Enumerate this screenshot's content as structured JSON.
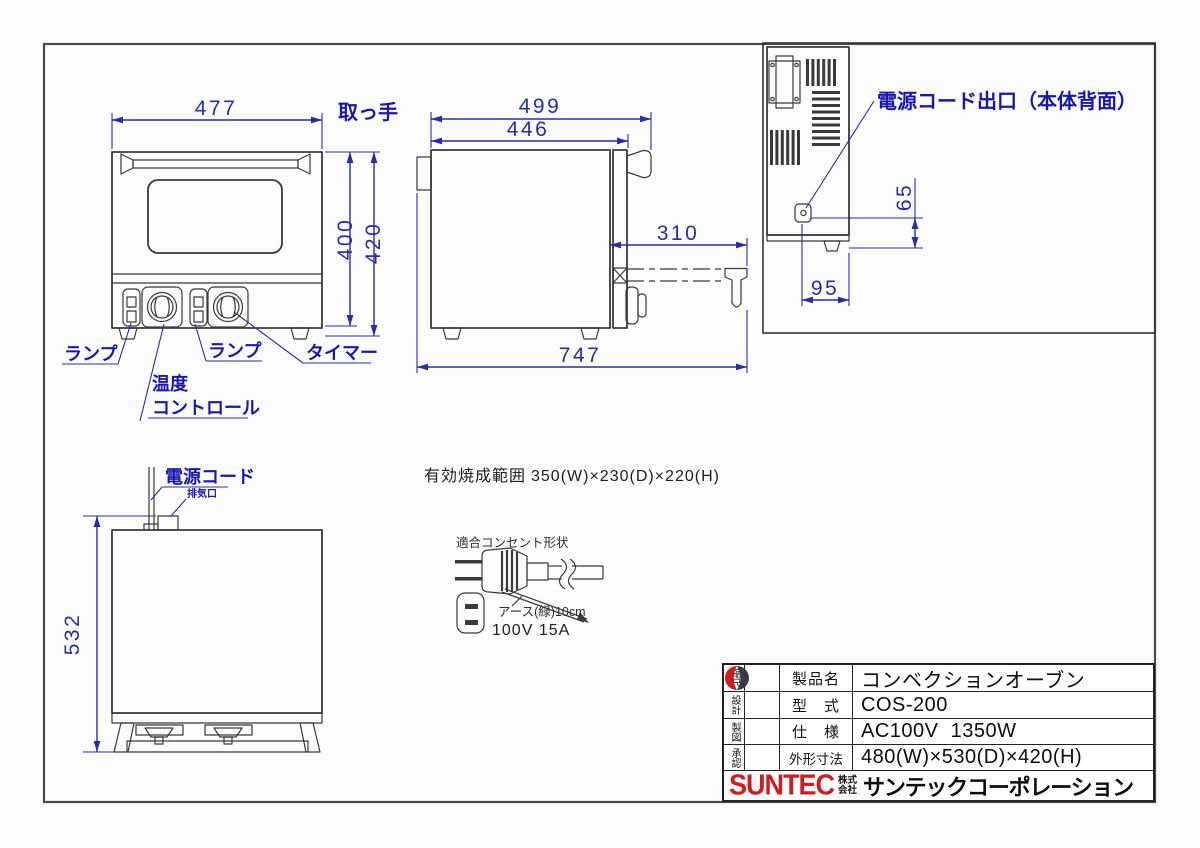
{
  "front_view": {
    "handle_label": "取っ手",
    "dim_width": "477",
    "dim_height_body": "400",
    "dim_height_total": "420",
    "label_lamp_left": "ランプ",
    "label_temp_line1": "温度",
    "label_temp_line2": "コントロール",
    "label_lamp_right": "ランプ",
    "label_timer": "タイマー"
  },
  "side_view": {
    "dim_width_total": "499",
    "dim_width_body": "446",
    "dim_door_open": "310",
    "dim_depth_total": "747"
  },
  "back_view": {
    "label_cord_outlet": "電源コード出口（本体背面）",
    "dim_outlet_height": "65",
    "dim_outlet_offset": "95"
  },
  "top_view": {
    "label_power_cord": "電源コード",
    "label_vent": "排気口",
    "dim_depth": "532"
  },
  "notes": {
    "baking_range_label": "有効焼成範囲",
    "baking_range_value": "350(W)×230(D)×220(H)",
    "plug_title": "適合コンセント形状",
    "ground_label": "アース(緑)10cm",
    "rating": "100V 15A"
  },
  "title_block": {
    "side_labels": [
      "縮尺",
      "設計",
      "製図",
      "承認"
    ],
    "rows": [
      {
        "label": "製品名",
        "value": "コンベクションオーブン"
      },
      {
        "label": "型　式",
        "value": "COS-200"
      },
      {
        "label": "仕　様",
        "value": "AC100V  1350W"
      },
      {
        "label": "外形寸法",
        "value": "480(W)×530(D)×420(H)"
      }
    ],
    "brand": "SUNTEC",
    "company_prefix": "株式会社",
    "company_name": "サンテックコーポレーション"
  },
  "colors": {
    "dimension_blue": "#2b2ba8",
    "label_blue": "#1717b0",
    "line_dark": "#3a3a3a",
    "brand_red": "#cf1c1c"
  }
}
